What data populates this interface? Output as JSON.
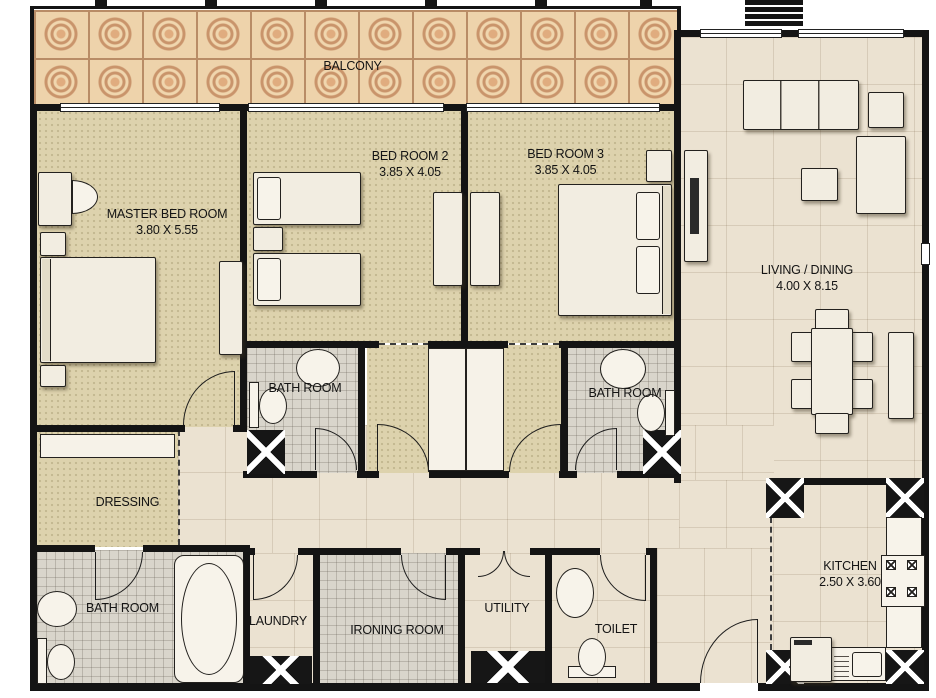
{
  "plan": {
    "type": "apartment-floor-plan",
    "rooms": [
      {
        "name": "balcony",
        "label": "BALCONY"
      },
      {
        "name": "master-bedroom",
        "label": "MASTER BED ROOM",
        "dims": "3.80 X 5.55"
      },
      {
        "name": "bedroom-2",
        "label": "BED ROOM 2",
        "dims": "3.85 X 4.05"
      },
      {
        "name": "bedroom-3",
        "label": "BED ROOM 3",
        "dims": "3.85 X 4.05"
      },
      {
        "name": "living-dining",
        "label": "LIVING / DINING",
        "dims": "4.00 X 8.15"
      },
      {
        "name": "bathroom-2",
        "label": "BATH ROOM"
      },
      {
        "name": "bathroom-3",
        "label": "BATH ROOM"
      },
      {
        "name": "dressing",
        "label": "DRESSING"
      },
      {
        "name": "master-bathroom",
        "label": "BATH ROOM"
      },
      {
        "name": "laundry",
        "label": "LAUNDRY"
      },
      {
        "name": "ironing-room",
        "label": "IRONING ROOM"
      },
      {
        "name": "utility",
        "label": "UTILITY"
      },
      {
        "name": "toilet",
        "label": "TOILET"
      },
      {
        "name": "kitchen",
        "label": "KITCHEN",
        "dims": "2.50 X 3.60"
      }
    ],
    "colors": {
      "wall": "#141414",
      "bedroom_floor": "#ddd2ad",
      "marble_floor": "#ebe2d1",
      "mosaic_floor": "#d9d5cb",
      "balcony_tile": "#eed3ab",
      "balcony_ring": "#c9946b",
      "furniture": "#f2ede1"
    }
  }
}
